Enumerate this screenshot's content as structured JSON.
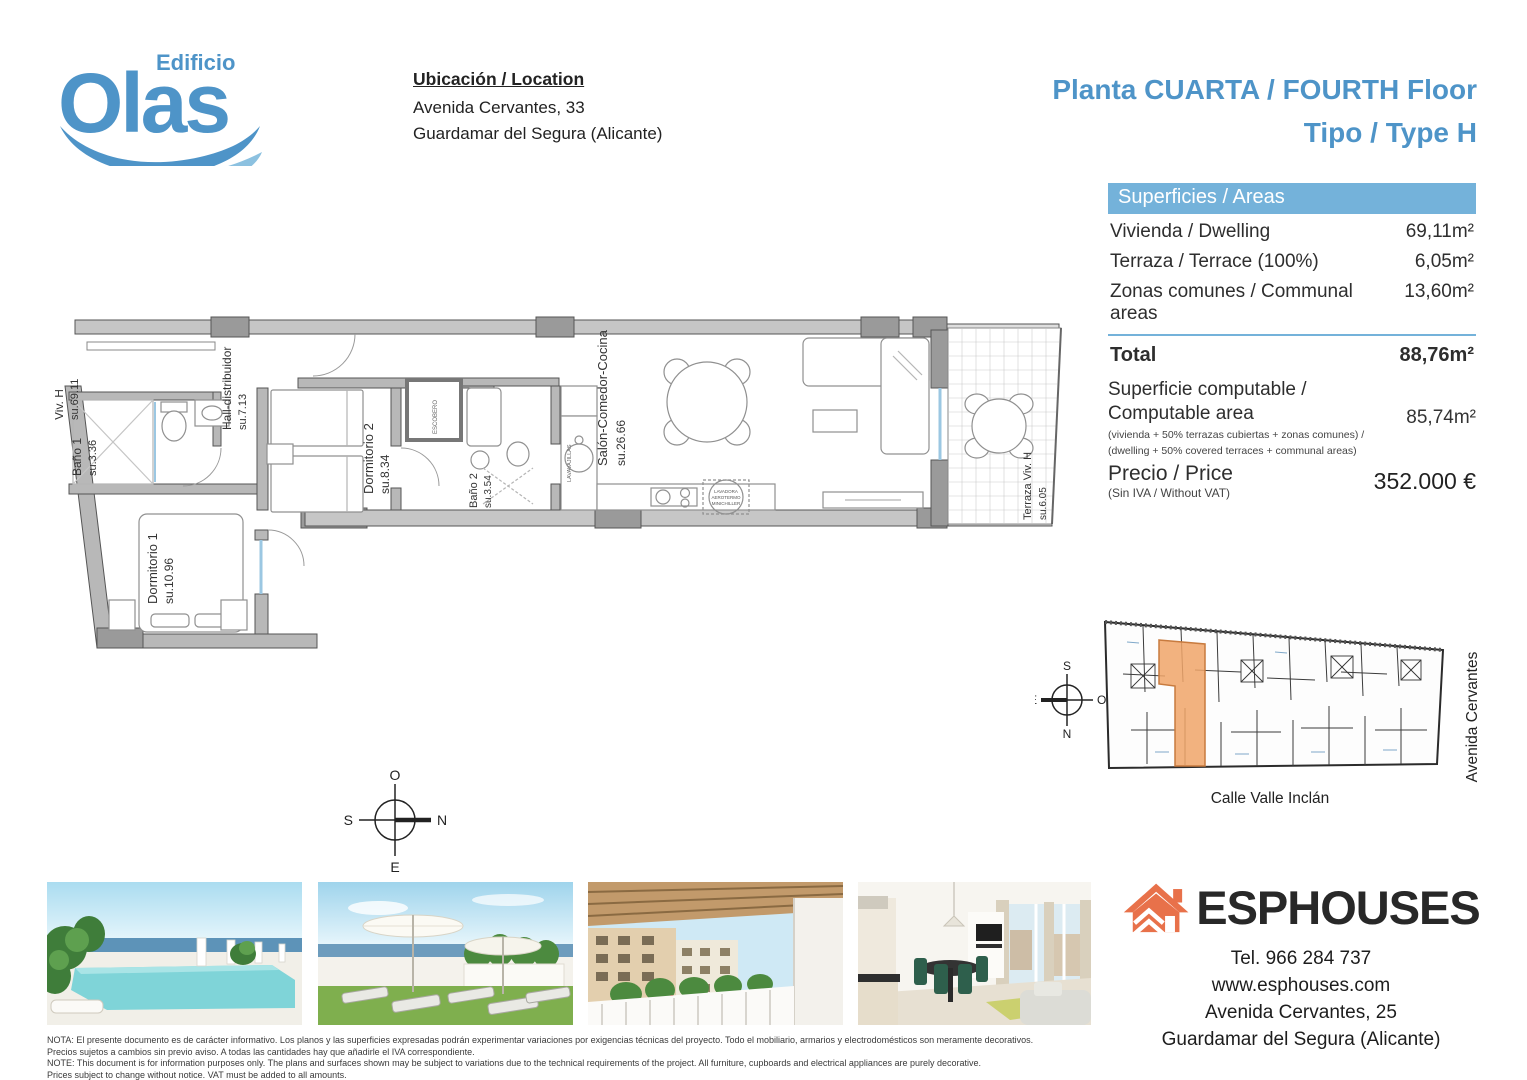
{
  "brand": {
    "sub": "Edificio",
    "name": "Olas"
  },
  "location": {
    "heading": "Ubicación / Location",
    "address1": "Avenida Cervantes, 33",
    "address2": "Guardamar del Segura (Alicante)"
  },
  "title": {
    "line1": "Planta CUARTA / FOURTH Floor",
    "line2": "Tipo / Type H"
  },
  "areas": {
    "header": "Superficies / Areas",
    "rows": [
      {
        "label": "Vivienda / Dwelling",
        "value": "69,11m²"
      },
      {
        "label": "Terraza / Terrace (100%)",
        "value": "6,05m²"
      },
      {
        "label": "Zonas comunes / Communal areas",
        "value": "13,60m²"
      }
    ],
    "total_label": "Total",
    "total_value": "88,76m²",
    "computable_label1": "Superficie computable /",
    "computable_label2": "Computable area",
    "computable_note1": "(vivienda + 50% terrazas cubiertas + zonas comunes) /",
    "computable_note2": "(dwelling + 50% covered terraces + communal areas)",
    "computable_value": "85,74m²"
  },
  "price": {
    "label": "Precio / Price",
    "note": "(Sin IVA / Without VAT)",
    "value": "352.000 €"
  },
  "floorplan": {
    "unit_label": {
      "name": "Viv. H",
      "area": "su.69.11"
    },
    "rooms": [
      {
        "name": "Baño 1",
        "area": "su.3.36"
      },
      {
        "name": "Hall-distribuidor",
        "area": "su.7.13"
      },
      {
        "name": "Dormitorio 1",
        "area": "su.10.96"
      },
      {
        "name": "Dormitorio 2",
        "area": "su.8.34"
      },
      {
        "name": "Baño 2",
        "area": "su.3.54"
      },
      {
        "name": "Salón-Comedor-Cocina",
        "area": "su.26.66"
      },
      {
        "name": "Terraza Viv. H",
        "area": "su.6.05"
      }
    ],
    "small_labels": {
      "closet": "ESCOBERO",
      "dishwasher": "LAVAVAJILLAS",
      "utility1": "LAVADORA",
      "utility2": "AEROTERMO",
      "utility3": "MINICHILLER"
    },
    "compass": {
      "top": "O",
      "left": "S",
      "right": "N",
      "bottom": "E"
    }
  },
  "siteplan": {
    "compass": {
      "top": "S",
      "left": "E",
      "right": "O",
      "bottom": "N"
    },
    "street_bottom": "Calle Valle Inclán",
    "street_right": "Avenida Cervantes"
  },
  "agency": {
    "name": "ESPHOUSES",
    "phone": "Tel. 966 284 737",
    "website": "www.esphouses.com",
    "address1": "Avenida Cervantes, 25",
    "address2": "Guardamar del Segura (Alicante)"
  },
  "disclaimer": {
    "line1": "NOTA: El presente documento es de carácter informativo. Los planos y las superficies expresadas podrán experimentar variaciones por exigencias técnicas del proyecto. Todo el mobiliario, armarios y electrodomésticos son meramente decorativos.",
    "line2": "Precios sujetos a cambios sin previo aviso. A todas las cantidades hay que añadirle el IVA correspondiente.",
    "line3": "NOTE: This document is for information purposes only. The plans and surfaces shown may be subject to variations due to the technical requirements of the project. All furniture, cupboards and electrical appliances are purely decorative.",
    "line4": "Prices subject to change without notice. VAT must be added to all amounts."
  },
  "colors": {
    "accent_blue": "#4E94C8",
    "table_header_blue": "#74B2DA",
    "logo_blue": "#4E94C8",
    "logo_wave_light": "#8CC1E0",
    "agency_orange": "#E8714A",
    "highlight_orange": "#F0A468",
    "wall_gray": "#b8b8b8"
  }
}
